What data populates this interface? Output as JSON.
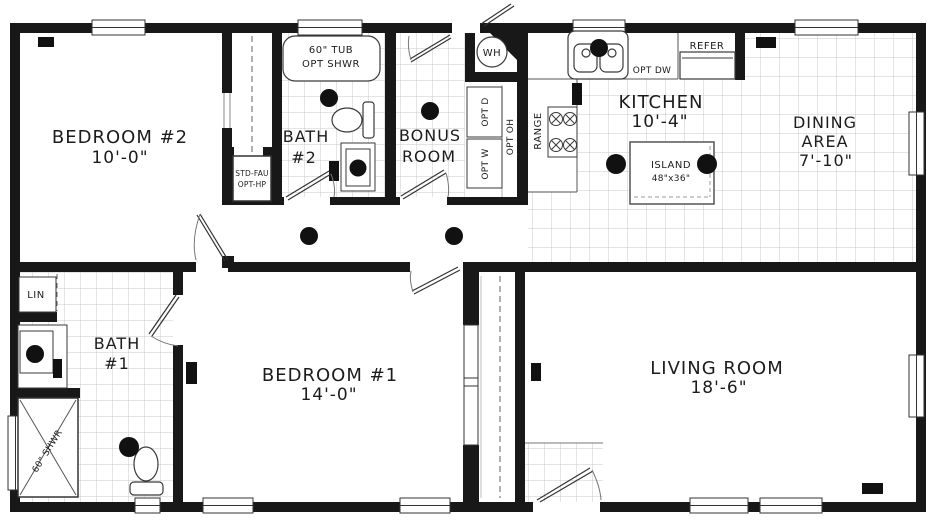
{
  "plan": {
    "rooms": {
      "bedroom2": {
        "name": "BEDROOM #2",
        "dim": "10'-0\""
      },
      "bath2": {
        "name": "BATH",
        "num": "#2"
      },
      "bonus": {
        "line1": "BONUS",
        "line2": "ROOM"
      },
      "kitchen": {
        "name": "KITCHEN",
        "dim": "10'-4\""
      },
      "dining": {
        "line1": "DINING",
        "line2": "AREA",
        "dim": "7'-10\""
      },
      "bath1": {
        "name": "BATH",
        "num": "#1"
      },
      "bedroom1": {
        "name": "BEDROOM #1",
        "dim": "14'-0\""
      },
      "living": {
        "name": "LIVING ROOM",
        "dim": "18'-6\""
      }
    },
    "labels": {
      "tub_line1": "60\" TUB",
      "tub_line2": "OPT SHWR",
      "water_heater": "WH",
      "refrigerator": "REFER",
      "opt_dishwasher": "OPT DW",
      "opt_dryer": "OPT D",
      "opt_washer": "OPT W",
      "opt_overhead": "OPT OH",
      "range": "RANGE",
      "island": "ISLAND",
      "island_size": "48\"x36\"",
      "furnace_line1": "STD-FAU",
      "furnace_line2": "OPT-HP",
      "linen": "LIN",
      "shower": "60\" SHWR"
    },
    "colors": {
      "wall": "#181818",
      "tile_grid": "#c9c9c9",
      "line": "#3a3a3a"
    }
  }
}
